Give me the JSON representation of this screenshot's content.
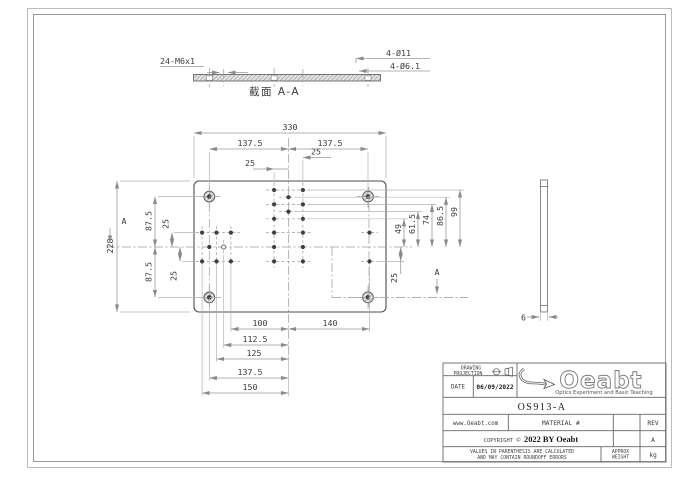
{
  "section_view": {
    "thread_callout": "24-M6x1",
    "cbore_callout": "4-Ø11",
    "thru_callout": "4-Ø6.1",
    "caption": "截面  A-A"
  },
  "plan_view": {
    "section_label_left": "A",
    "section_label_right": "A",
    "dims": {
      "overall_width": "330",
      "half_left": "137.5",
      "half_right": "137.5",
      "top_25_left": "25",
      "top_25_right": "25",
      "overall_height": "228",
      "upper_875": "87.5",
      "lower_875": "87.5",
      "left_25_upper": "25",
      "left_25_lower": "25",
      "right_49": "49",
      "right_615": "61.5",
      "right_74": "74",
      "right_865": "86.5",
      "right_99": "99",
      "right_25": "25",
      "bottom_100": "100",
      "bottom_140": "140",
      "bottom_1125": "112.5",
      "bottom_125": "125",
      "bottom_1375": "137.5",
      "bottom_150": "150"
    }
  },
  "side_view": {
    "thickness": "6"
  },
  "title_block": {
    "projection_line1": "DRAWING",
    "projection_line2": "PROJECTION",
    "date_label": "DATE",
    "date_value": "06/09/2022",
    "logo_text": "Oeabt",
    "logo_tagline": "Optics Experiment and Basic Teaching",
    "part_number": "OS913-A",
    "website": "www.Oeabt.com",
    "material_label": "MATERIAL #",
    "rev_label": "REV",
    "rev_value": "A",
    "copyright_label": "COPYRIGHT",
    "copyright_symbol": "©",
    "copyright_text": "2022 BY Oeabt",
    "disclaimer_line1": "VALUES IN PARENTHESIS ARE CALCULATED",
    "disclaimer_line2": "AND MAY CONTAIN ROUNDOFF ERRORS",
    "weight_line1": "APPROX",
    "weight_line2": "WEIGHT",
    "weight_unit": "kg"
  },
  "colors": {
    "object_line": "#4d4d4d",
    "dim_line": "#9a9a9a",
    "border": "#aaaaaa",
    "text": "#3c3c3c"
  }
}
